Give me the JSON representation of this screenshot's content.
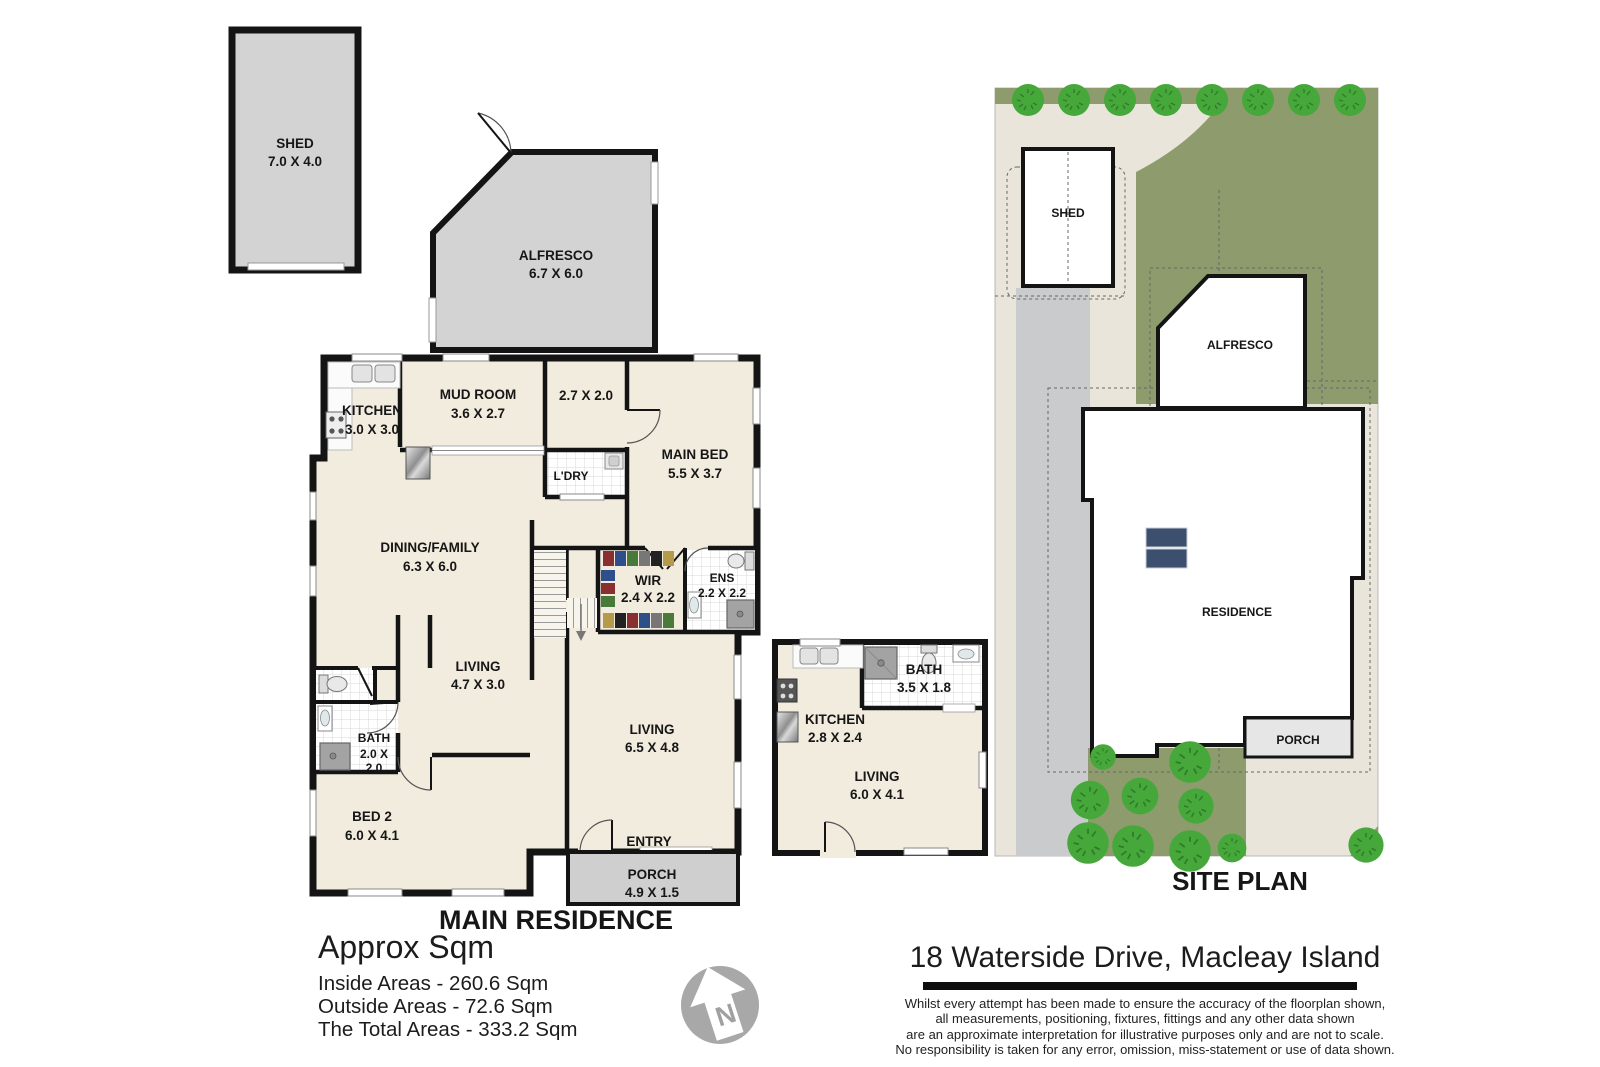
{
  "title_block": {
    "main_plan_title": "MAIN RESIDENCE",
    "site_plan_title": "SITE PLAN",
    "address": "18 Waterside Drive, Macleay Island",
    "summary_heading": "Approx Sqm",
    "summary_lines": [
      "Inside Areas - 260.6 Sqm",
      "Outside Areas - 72.6 Sqm",
      "The Total Areas - 333.2 Sqm"
    ],
    "disclaimer_lines": [
      "Whilst every attempt has been made to ensure the accuracy of the floorplan shown,",
      "all measurements, positioning, fixtures, fittings and any other data shown",
      "are an approximate interpretation for illustrative purposes only and are not to scale.",
      "No responsibility is taken for any error, omission, miss-statement or use of data shown."
    ],
    "compass_letter": "N"
  },
  "shed": {
    "label": "SHED",
    "dims": "7.0 X 4.0"
  },
  "alfresco": {
    "label": "ALFRESCO",
    "dims": "6.7 X 6.0"
  },
  "main": {
    "kitchen": {
      "label": "KITCHEN",
      "dims": "3.0 X 3.0"
    },
    "mud_room": {
      "label": "MUD ROOM",
      "dims": "3.6 X 2.7"
    },
    "room_2_7": {
      "dims": "2.7 X 2.0"
    },
    "main_bed": {
      "label": "MAIN BED",
      "dims": "5.5 X 3.7"
    },
    "laundry": {
      "label": "L'DRY"
    },
    "dining_family": {
      "label": "DINING/FAMILY",
      "dims": "6.3 X 6.0"
    },
    "wir": {
      "label": "WIR",
      "dims": "2.4 X 2.2"
    },
    "ens": {
      "label": "ENS",
      "dims": "2.2 X 2.2"
    },
    "living_small": {
      "label": "LIVING",
      "dims": "4.7 X 3.0"
    },
    "bath": {
      "label": "BATH",
      "dims_l1": "2.0 X",
      "dims_l2": "2.0"
    },
    "bed2": {
      "label": "BED 2",
      "dims": "6.0 X 4.1"
    },
    "living_large": {
      "label": "LIVING",
      "dims": "6.5 X 4.8"
    },
    "entry": {
      "label": "ENTRY"
    },
    "porch": {
      "label": "PORCH",
      "dims": "4.9 X 1.5"
    }
  },
  "granny_flat": {
    "bath": {
      "label": "BATH",
      "dims": "3.5 X 1.8"
    },
    "kitchen": {
      "label": "KITCHEN",
      "dims": "2.8 X 2.4"
    },
    "living": {
      "label": "LIVING",
      "dims": "6.0 X 4.1"
    }
  },
  "site": {
    "shed_label": "SHED",
    "alfresco_label": "ALFRESCO",
    "residence_label": "RESIDENCE",
    "porch_label": "PORCH"
  },
  "colors": {
    "wall": "#141414",
    "floor": "#f2ecdf",
    "outdoor_gray": "#d3d3d3",
    "lawn": "#8e9c6d",
    "tree": "#46a83b",
    "paving": "#e9e5db",
    "concrete": "#c9cbcc",
    "panel_navy": "#3d4f6e"
  }
}
